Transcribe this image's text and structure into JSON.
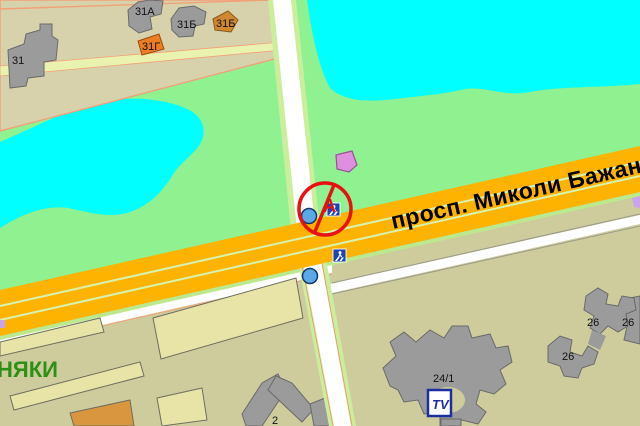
{
  "street": {
    "name_label": "просп. Миколи Бажана"
  },
  "district": {
    "name_fragment": "НЯКИ"
  },
  "buildings": {
    "b31": "31",
    "b31a": "31А",
    "b31b_1": "31Б",
    "b31b_2": "31Б",
    "b31g": "31Г",
    "b2": "2",
    "b24_1": "24/1",
    "b26_1": "26",
    "b26_2": "26",
    "b26_3": "26"
  },
  "signs": {
    "no_service_letter": "А",
    "tv_poi_label": "TV"
  },
  "icons": [
    "no-entry-icon",
    "pedestrian-crossing-icon",
    "bus-stop-icon",
    "tv-poi-icon"
  ],
  "colors": {
    "park": "#8FF18F",
    "water": "#00FFFF",
    "block_beige": "#D8D2AC",
    "block_khaki": "#CECC9C",
    "building_pale": "#E8E4A8",
    "building_gray": "#9B9B9B",
    "building_orange": "#ED7D21",
    "building_orange_brown": "#D1892F",
    "building_sandy": "#D9963E",
    "building_pink": "#DE90DE",
    "road_primary": "#FEB300",
    "road_white": "#FFFFFF",
    "road_edge_green": "#CBEE9C",
    "lane_line": "#D8F3AE",
    "boundary_salmon": "#F2A078",
    "sign_blue": "#1C44B4",
    "stop_blue": "#5AA9E6",
    "no_entry_red": "#E81010",
    "purple_poi": "#C8A4EA"
  }
}
